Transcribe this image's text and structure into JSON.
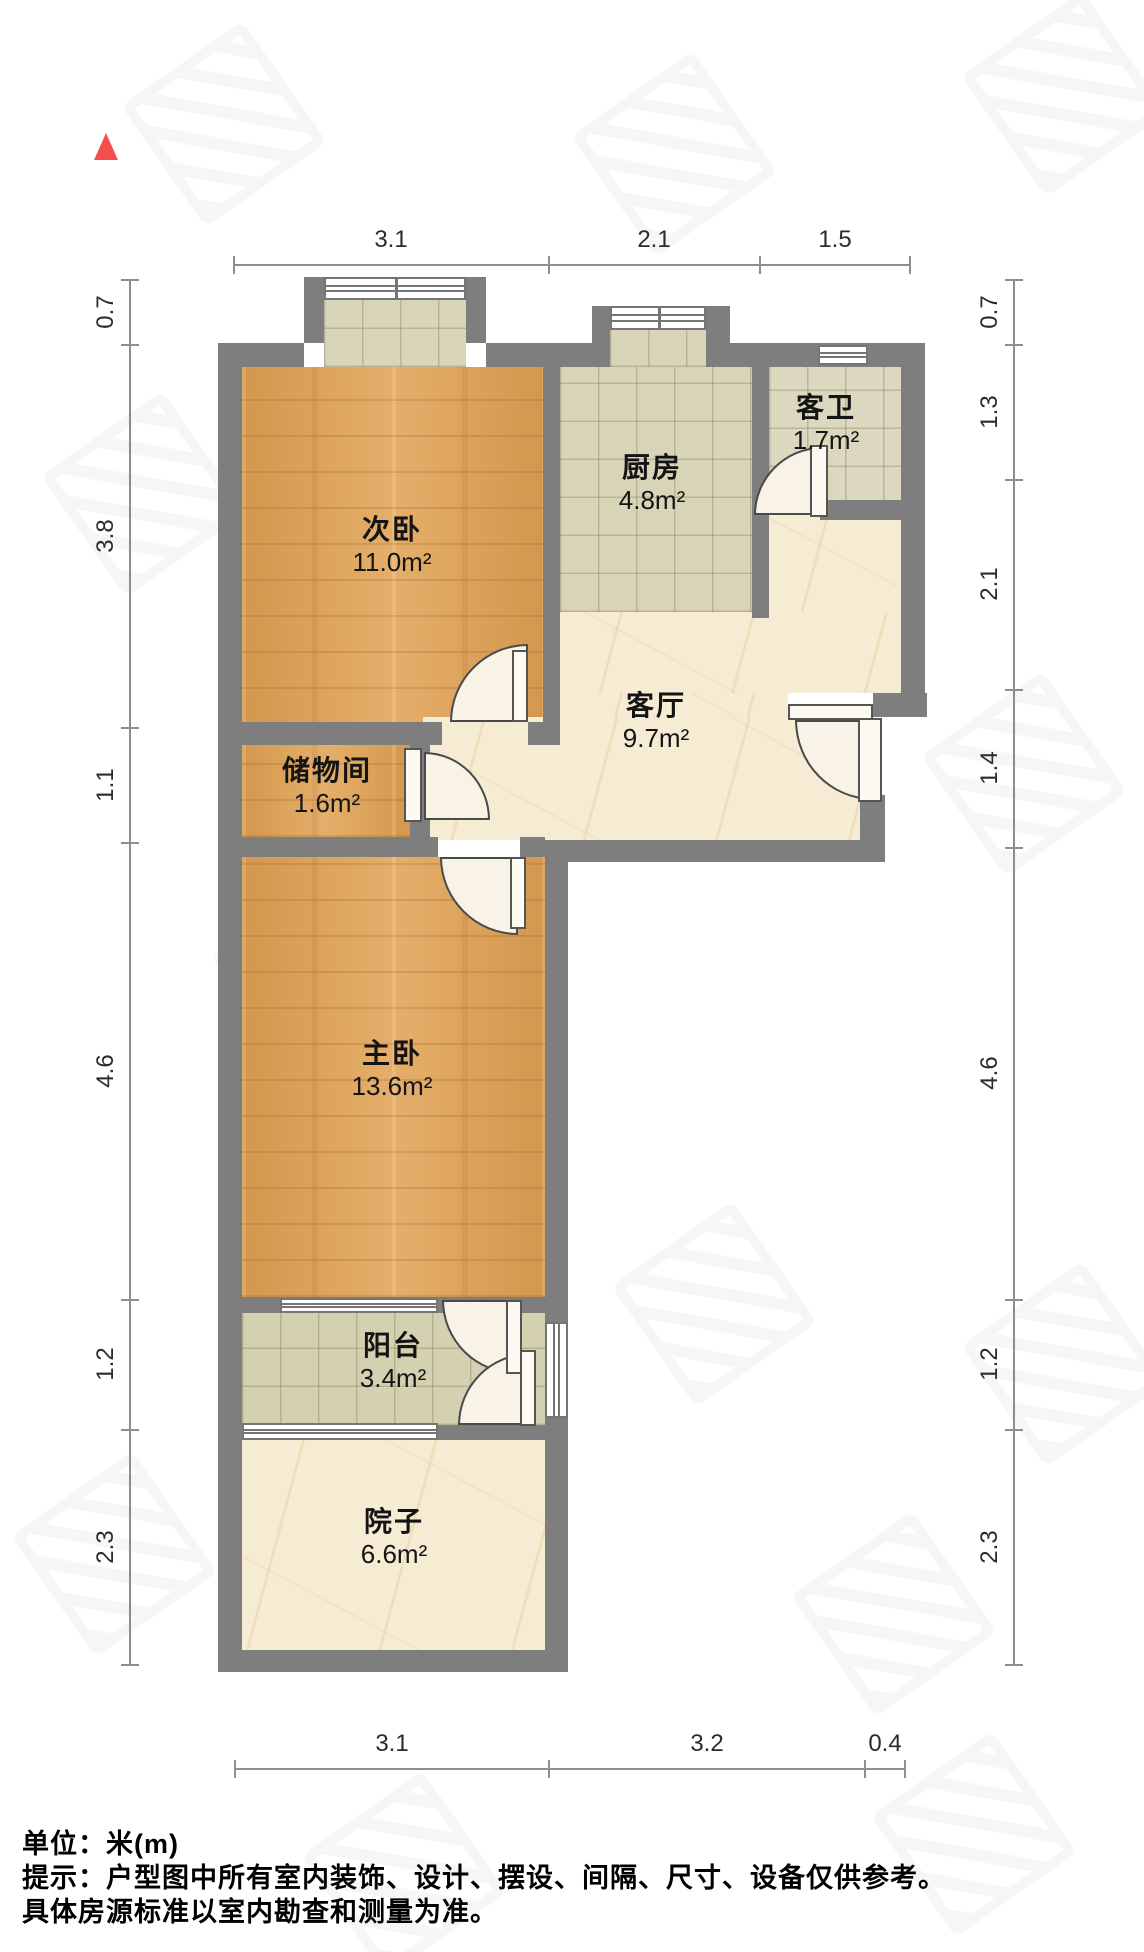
{
  "north_indicator": {
    "color": "#f2504f"
  },
  "rooms": [
    {
      "name": "次卧",
      "area": "11.0m²"
    },
    {
      "name": "厨房",
      "area": "4.8m²"
    },
    {
      "name": "客卫",
      "area": "1.7m²"
    },
    {
      "name": "客厅",
      "area": "9.7m²"
    },
    {
      "name": "储物间",
      "area": "1.6m²"
    },
    {
      "name": "主卧",
      "area": "13.6m²"
    },
    {
      "name": "阳台",
      "area": "3.4m²"
    },
    {
      "name": "院子",
      "area": "6.6m²"
    }
  ],
  "dimensions": {
    "top": [
      "3.1",
      "2.1",
      "1.5"
    ],
    "bottom": [
      "3.1",
      "3.2",
      "0.4"
    ],
    "left": [
      "0.7",
      "3.8",
      "1.1",
      "4.6",
      "1.2",
      "2.3"
    ],
    "right": [
      "0.7",
      "1.3",
      "2.1",
      "1.4",
      "4.6",
      "1.2",
      "2.3"
    ]
  },
  "footer": {
    "unit_label": "单位：米(m)",
    "note_line1": "提示：户型图中所有室内装饰、设计、摆设、间隔、尺寸、设备仅供参考。",
    "note_line2": "具体房源标准以室内勘查和测量为准。"
  }
}
